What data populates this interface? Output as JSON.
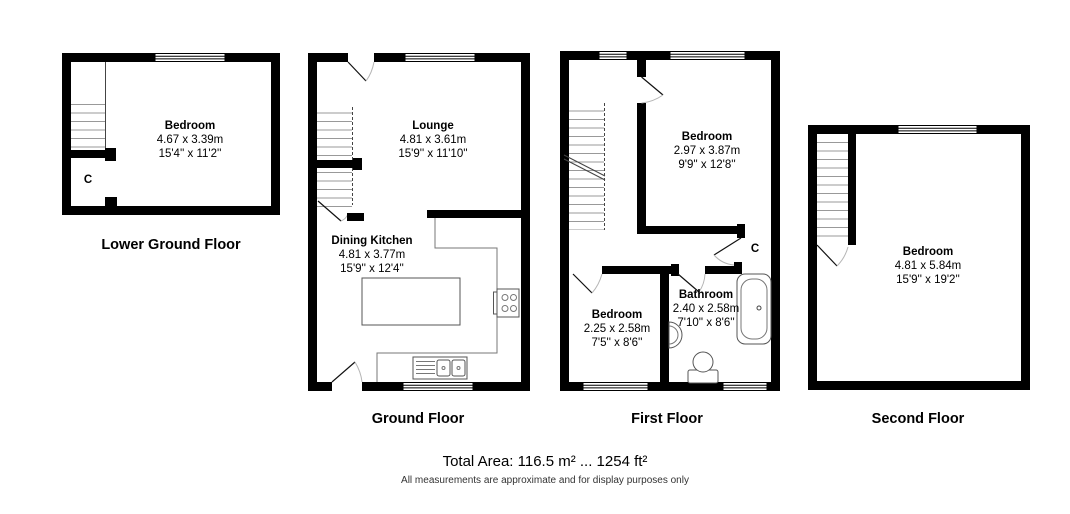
{
  "floor_labels": {
    "lower_ground": "Lower Ground Floor",
    "ground": "Ground Floor",
    "first": "First Floor",
    "second": "Second Floor"
  },
  "rooms": {
    "lgf_bedroom": {
      "name": "Bedroom",
      "metric": "4.67 x 3.39m",
      "imperial": "15'4'' x 11'2''"
    },
    "lounge": {
      "name": "Lounge",
      "metric": "4.81 x 3.61m",
      "imperial": "15'9'' x 11'10''"
    },
    "dining_kitchen": {
      "name": "Dining Kitchen",
      "metric": "4.81 x 3.77m",
      "imperial": "15'9'' x 12'4''"
    },
    "ff_bedroom": {
      "name": "Bedroom",
      "metric": "2.97 x 3.87m",
      "imperial": "9'9'' x 12'8''"
    },
    "ff_bedroom_small": {
      "name": "Bedroom",
      "metric": "2.25 x 2.58m",
      "imperial": "7'5'' x 8'6''"
    },
    "bathroom": {
      "name": "Bathroom",
      "metric": "2.40 x 2.58m",
      "imperial": "7'10'' x 8'6''"
    },
    "sf_bedroom": {
      "name": "Bedroom",
      "metric": "4.81 x 5.84m",
      "imperial": "15'9'' x 19'2''"
    }
  },
  "cupboards": {
    "lower_ground": "C",
    "first_floor": "C"
  },
  "footer": {
    "total_area": "Total Area: 116.5 m² ... 1254 ft²",
    "disclaimer": "All measurements are approximate and for display purposes only"
  },
  "colors": {
    "wall": "#000000",
    "stair_lines": "#999999",
    "fixture_lines": "#555555",
    "background": "#ffffff"
  }
}
